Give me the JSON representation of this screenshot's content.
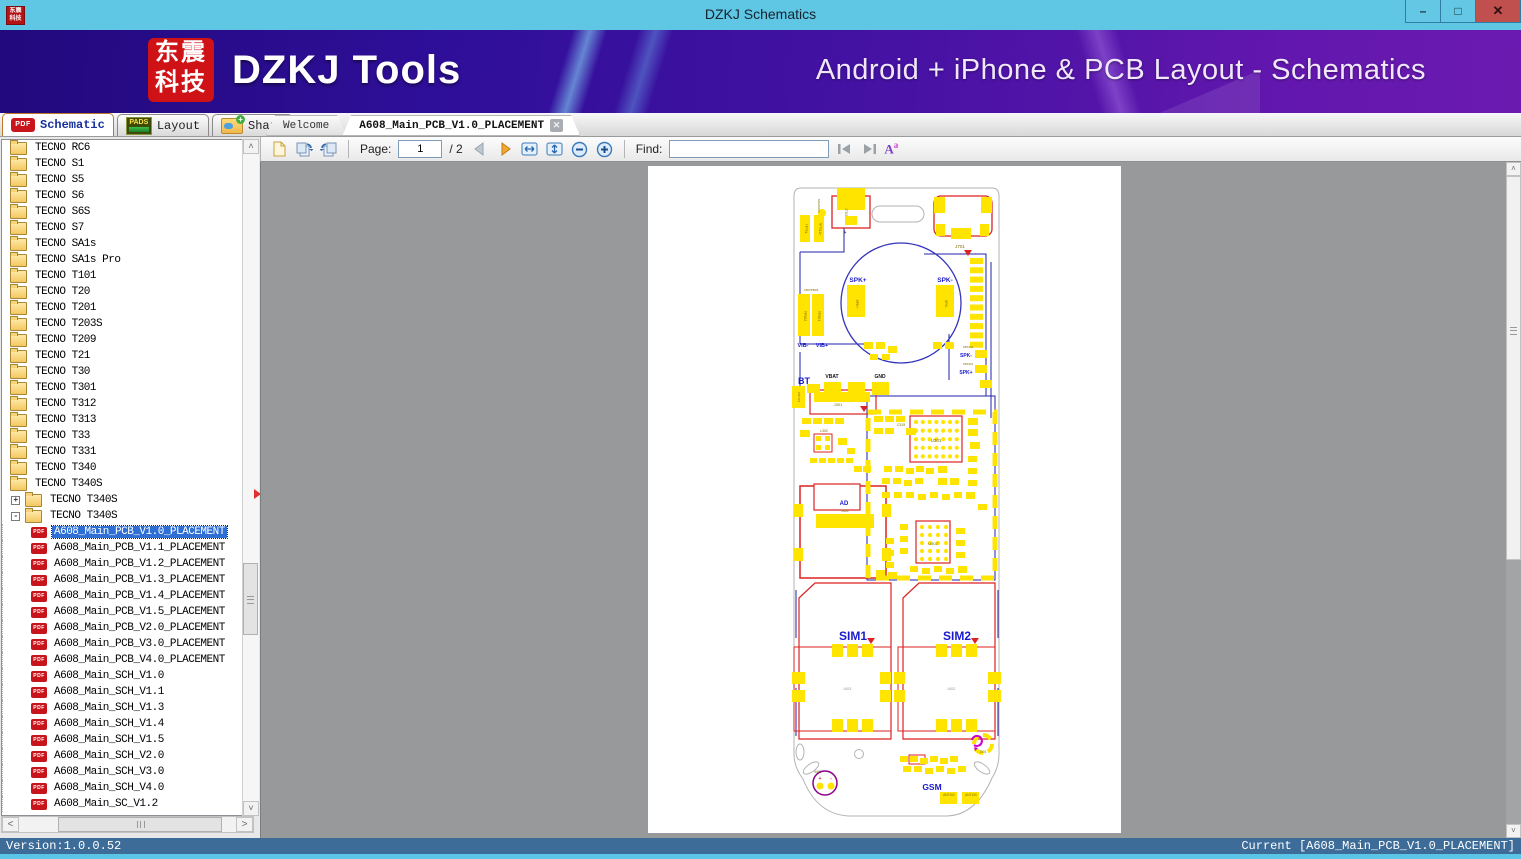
{
  "window": {
    "title": "DZKJ Schematics",
    "app_icon_lines": [
      "东震",
      "科技"
    ],
    "controls": {
      "minimize": "–",
      "maximize": "□",
      "close": "✕"
    }
  },
  "banner": {
    "logo_lines": [
      "东震",
      "科技"
    ],
    "brand": "DZKJ Tools",
    "tagline": "Android + iPhone & PCB Layout - Schematics"
  },
  "main_tabs": [
    {
      "label": "Schematic",
      "icon": "pdf-icon",
      "icon_text": "PDF",
      "active": true
    },
    {
      "label": "Layout",
      "icon": "pads-icon",
      "icon_text": "PADS",
      "active": false
    },
    {
      "label": "Share",
      "icon": "share-folder-icon",
      "icon_text": "",
      "active": false
    }
  ],
  "document_tabs": [
    {
      "label": "Welcome",
      "active": false,
      "closable": false
    },
    {
      "label": "A608_Main_PCB_V1.0_PLACEMENT",
      "active": true,
      "closable": true,
      "close_glyph": "✕"
    }
  ],
  "toolbar": {
    "icons": [
      "new-page-icon",
      "rotate-left-icon",
      "rotate-right-icon",
      "prev-page-icon",
      "next-page-icon",
      "fit-width-icon",
      "fit-page-icon",
      "zoom-out-icon",
      "zoom-in-icon",
      "find-previous-icon",
      "find-next-icon",
      "match-case-icon"
    ],
    "page_label": "Page:",
    "page_value": "1",
    "page_total": "/ 2",
    "find_label": "Find:",
    "find_value": "",
    "match_case_main": "A",
    "match_case_sup": "a"
  },
  "tree": {
    "folders": [
      "TECNO RC6",
      "TECNO S1",
      "TECNO S5",
      "TECNO S6",
      "TECNO S6S",
      "TECNO S7",
      "TECNO SA1s",
      "TECNO SA1s Pro",
      "TECNO T101",
      "TECNO T20",
      "TECNO T201",
      "TECNO T203S",
      "TECNO T209",
      "TECNO T21",
      "TECNO T30",
      "TECNO T301",
      "TECNO T312",
      "TECNO T313",
      "TECNO T33",
      "TECNO T331",
      "TECNO T340",
      "TECNO T340S"
    ],
    "nested": [
      {
        "label": "TECNO T340S",
        "expander": "+"
      },
      {
        "label": "TECNO T340S",
        "expander": "-"
      }
    ],
    "files": [
      "A608_Main_PCB_V1.0_PLACEMENT",
      "A608_Main_PCB_V1.1_PLACEMENT",
      "A608_Main_PCB_V1.2_PLACEMENT",
      "A608_Main_PCB_V1.3_PLACEMENT",
      "A608_Main_PCB_V1.4_PLACEMENT",
      "A608_Main_PCB_V1.5_PLACEMENT",
      "A608_Main_PCB_V2.0_PLACEMENT",
      "A608_Main_PCB_V3.0_PLACEMENT",
      "A608_Main_PCB_V4.0_PLACEMENT",
      "A608_Main_SCH_V1.0",
      "A608_Main_SCH_V1.1",
      "A608_Main_SCH_V1.3",
      "A608_Main_SCH_V1.4",
      "A608_Main_SCH_V1.5",
      "A608_Main_SCH_V2.0",
      "A608_Main_SCH_V3.0",
      "A608_Main_SCH_V4.0",
      "A608_Main_SC_V1.2"
    ],
    "selected_file_index": 0
  },
  "pcb": {
    "labels": [
      {
        "t": "J702",
        "x": 197,
        "y": 46,
        "s": 4,
        "c": "#7a6a00",
        "r": 90
      },
      {
        "t": "MARK101",
        "x": 170,
        "y": 40,
        "s": 3,
        "c": "#7a6a00",
        "r": 90
      },
      {
        "t": "TP751-",
        "x": 157,
        "y": 63,
        "s": 3.2,
        "c": "#7a6a00",
        "r": 90
      },
      {
        "t": "TP751A+",
        "x": 171,
        "y": 63,
        "s": 3.2,
        "c": "#7a6a00",
        "r": 90
      },
      {
        "t": "+",
        "x": 197,
        "y": 68,
        "s": 5,
        "c": "#444",
        "b": 1
      },
      {
        "t": "J701",
        "x": 312,
        "y": 82,
        "s": 4.5,
        "c": "#7a6a00"
      },
      {
        "t": "SPK+",
        "x": 210,
        "y": 116,
        "s": 6.5,
        "c": "#1a1acc",
        "b": 1
      },
      {
        "t": "SPK-",
        "x": 297,
        "y": 116,
        "s": 6.5,
        "c": "#1a1acc",
        "b": 1
      },
      {
        "t": "SPK+",
        "x": 208,
        "y": 138,
        "s": 3.5,
        "c": "#7a6a00",
        "r": 90
      },
      {
        "t": "SPK-",
        "x": 297,
        "y": 138,
        "s": 3.5,
        "c": "#7a6a00",
        "r": 90
      },
      {
        "t": "TP502",
        "x": 156,
        "y": 150,
        "s": 3.5,
        "c": "#7a6a00",
        "r": 90
      },
      {
        "t": "TP501",
        "x": 170,
        "y": 150,
        "s": 3.5,
        "c": "#7a6a00",
        "r": 90
      },
      {
        "t": "C807PB03",
        "x": 163,
        "y": 125,
        "s": 3,
        "c": "#7a6a00"
      },
      {
        "t": "VIB-",
        "x": 155,
        "y": 181,
        "s": 5.5,
        "c": "#1a1acc",
        "b": 1
      },
      {
        "t": "VIB+",
        "x": 174,
        "y": 181,
        "s": 5.5,
        "c": "#1a1acc",
        "b": 1
      },
      {
        "t": "SPK-",
        "x": 318,
        "y": 191,
        "s": 5,
        "c": "#1a1acc",
        "b": 1
      },
      {
        "t": "SPK+",
        "x": 318,
        "y": 208,
        "s": 5,
        "c": "#1a1acc",
        "b": 1
      },
      {
        "t": "SPK302",
        "x": 320,
        "y": 182,
        "s": 2.8,
        "c": "#7a6a00"
      },
      {
        "t": "SPK301",
        "x": 320,
        "y": 199,
        "s": 2.8,
        "c": "#7a6a00"
      },
      {
        "t": "BT",
        "x": 156,
        "y": 218,
        "s": 9,
        "c": "#1a1acc",
        "b": 1
      },
      {
        "t": "VBAT",
        "x": 184,
        "y": 212,
        "s": 5,
        "c": "#111",
        "b": 1
      },
      {
        "t": "GND",
        "x": 232,
        "y": 212,
        "s": 5,
        "c": "#111",
        "b": 1
      },
      {
        "t": "ANT103",
        "x": 150,
        "y": 231,
        "s": 2.8,
        "c": "#7a6a00",
        "r": 90
      },
      {
        "t": "J301",
        "x": 190,
        "y": 240,
        "s": 4,
        "c": "#7a6a00"
      },
      {
        "t": "L302",
        "x": 176,
        "y": 266,
        "s": 3.5,
        "c": "#7a6a00"
      },
      {
        "t": "U301",
        "x": 288,
        "y": 276,
        "s": 4.5,
        "c": "#7a6a00"
      },
      {
        "t": "C315",
        "x": 253,
        "y": 260,
        "s": 3.5,
        "c": "#7a6a00"
      },
      {
        "t": "AD",
        "x": 196,
        "y": 339,
        "s": 6,
        "c": "#1a1acc",
        "b": 1
      },
      {
        "t": "J401",
        "x": 197,
        "y": 346,
        "s": 3.5,
        "c": "#7a6a00"
      },
      {
        "t": "U302",
        "x": 285,
        "y": 379,
        "s": 4,
        "c": "#7a6a00"
      },
      {
        "t": "SIM1",
        "x": 205,
        "y": 474,
        "s": 12,
        "c": "#1a1acc",
        "b": 1
      },
      {
        "t": "SIM2",
        "x": 309,
        "y": 474,
        "s": 12,
        "c": "#1a1acc",
        "b": 1
      },
      {
        "t": "J403",
        "x": 199,
        "y": 524,
        "s": 4,
        "c": "#999999"
      },
      {
        "t": "J402",
        "x": 303,
        "y": 524,
        "s": 4,
        "c": "#999999"
      },
      {
        "t": "MIC",
        "x": 170,
        "y": 607,
        "s": 3.8,
        "c": "#7a6a00"
      },
      {
        "t": "J501",
        "x": 335,
        "y": 587,
        "s": 3.2,
        "c": "#7a6a00"
      },
      {
        "t": "GSM",
        "x": 284,
        "y": 624,
        "s": 8.5,
        "c": "#1a1acc",
        "b": 1
      },
      {
        "t": "ANT102",
        "x": 301,
        "y": 630,
        "s": 3.2,
        "c": "#7a6a00"
      },
      {
        "t": "ANT100",
        "x": 323,
        "y": 630,
        "s": 3.2,
        "c": "#7a6a00"
      }
    ]
  },
  "statusbar": {
    "left": "Version:1.0.0.52",
    "right": "Current [A608_Main_PCB_V1.0_PLACEMENT]"
  },
  "icons": {
    "scroll_up": "▲",
    "scroll_down": "▼",
    "scroll_left": "◄",
    "scroll_right": "►"
  }
}
